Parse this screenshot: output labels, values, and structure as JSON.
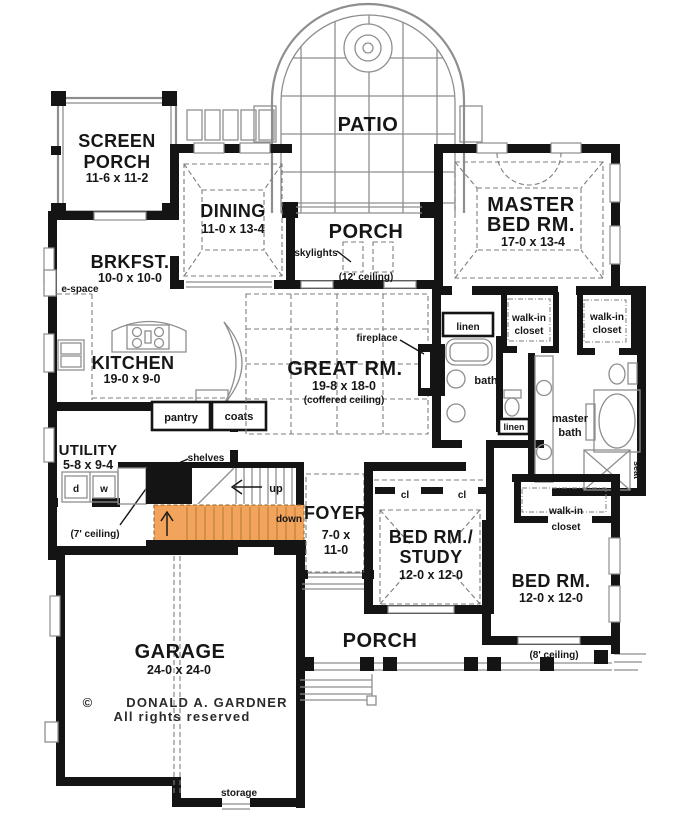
{
  "colors": {
    "wall": "#141414",
    "thin_line": "#8e8e8e",
    "dash_line": "#7d7d7d",
    "stair_highlight": "#F2A45C",
    "stair_tread": "#BD8438",
    "background": "#ffffff"
  },
  "plan": {
    "patio": {
      "label": "PATIO"
    },
    "screen_porch": {
      "line1": "SCREEN",
      "line2": "PORCH",
      "dims": "11-6 x 11-2"
    },
    "dining": {
      "label": "DINING",
      "dims": "11-0 x 13-4"
    },
    "rear_porch": {
      "label": "PORCH",
      "skylights": "skylights",
      "ceiling": "(12' ceiling)"
    },
    "master_bed": {
      "line1": "MASTER",
      "line2": "BED RM.",
      "dims": "17-0 x 13-4"
    },
    "brkfst": {
      "label": "BRKFST.",
      "dims": "10-0 x 10-0",
      "e_space": "e-space"
    },
    "kitchen": {
      "label": "KITCHEN",
      "dims": "19-0 x 9-0",
      "pantry": "pantry",
      "coats": "coats"
    },
    "great_rm": {
      "label": "GREAT RM.",
      "dims": "19-8 x 18-0",
      "ceiling": "(coffered ceiling)",
      "fireplace": "fireplace"
    },
    "bath_hall": {
      "linen_top": "linen",
      "bath": "bath",
      "linen_mid": "linen"
    },
    "walkin_closet_1": {
      "line1": "walk-in",
      "line2": "closet"
    },
    "walkin_closet_2": {
      "line1": "walk-in",
      "line2": "closet"
    },
    "walkin_closet_3": {
      "line1": "walk-in",
      "line2": "closet"
    },
    "master_bath": {
      "line1": "master",
      "line2": "bath",
      "seat": "seat"
    },
    "utility": {
      "label": "UTILITY",
      "dims": "5-8 x 9-4",
      "dryer": "d",
      "washer": "w",
      "shelves": "shelves",
      "ceiling": "(7' ceiling)"
    },
    "stairs": {
      "up": "up",
      "down": "down"
    },
    "foyer": {
      "label": "FOYER",
      "dims_line1": "7-0 x",
      "dims_line2": "11-0"
    },
    "bed_study": {
      "line1": "BED RM./",
      "line2": "STUDY",
      "dims": "12-0 x 12-0",
      "closet_left": "cl",
      "closet_right": "cl"
    },
    "bed_rm": {
      "label": "BED RM.",
      "dims": "12-0 x 12-0",
      "ceiling": "(8' ceiling)"
    },
    "garage": {
      "label": "GARAGE",
      "dims": "24-0 x 24-0",
      "storage": "storage"
    },
    "front_porch": {
      "label": "PORCH"
    },
    "copyright": {
      "symbol": "©",
      "name": "DONALD A. GARDNER",
      "rights": "All rights reserved"
    }
  }
}
